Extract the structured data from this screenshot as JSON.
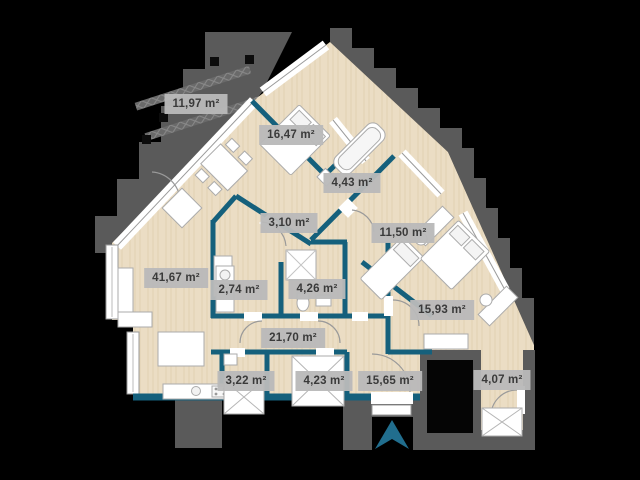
{
  "plan": {
    "title": "apartment-floor-plan",
    "unit_suffix": "m²",
    "rooms": [
      {
        "label": "11,97 m²"
      },
      {
        "label": "16,47 m²"
      },
      {
        "label": "4,43 m²"
      },
      {
        "label": "3,10 m²"
      },
      {
        "label": "11,50 m²"
      },
      {
        "label": "41,67 m²"
      },
      {
        "label": "2,74 m²"
      },
      {
        "label": "4,26 m²"
      },
      {
        "label": "15,93 m²"
      },
      {
        "label": "21,70 m²"
      },
      {
        "label": "3,22 m²"
      },
      {
        "label": "4,23 m²"
      },
      {
        "label": "15,65 m²"
      },
      {
        "label": "4,07 m²"
      }
    ],
    "colors": {
      "background": "#000000",
      "building_mass": "#5a5a5a",
      "floor_wood": "#ebddc4",
      "interior_wall": "#15607c",
      "window_frame": "#ffffff",
      "label_background": "#b9b9b9",
      "label_text": "#3a3a3a",
      "entrance_arrow": "#216e8e"
    }
  }
}
